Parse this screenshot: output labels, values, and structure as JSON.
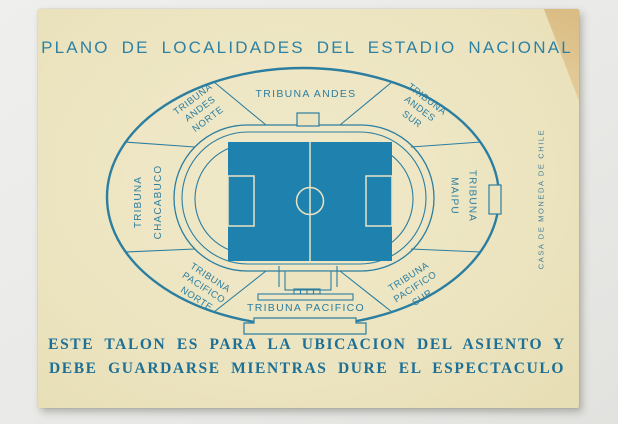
{
  "ticket": {
    "title": "PLANO DE LOCALIDADES DEL ESTADIO NACIONAL",
    "stadium": {
      "sections": {
        "andes": {
          "label": "TRIBUNA ANDES"
        },
        "andes_norte": {
          "lines": [
            "TRIBUNA",
            "ANDES",
            "NORTE"
          ]
        },
        "andes_sur": {
          "lines": [
            "TRIBUNA",
            "ANDES",
            "SUR"
          ]
        },
        "chacabuco": {
          "lines": [
            "TRIBUNA",
            "CHACABUCO"
          ]
        },
        "maipu": {
          "lines": [
            "TRIBUNA",
            "MAIPU"
          ]
        },
        "pacifico_norte": {
          "lines": [
            "TRIBUNA",
            "PACIFICO",
            "NORTE"
          ]
        },
        "pacifico": {
          "label": "TRIBUNA PACIFICO"
        },
        "pacifico_sur": {
          "lines": [
            "TRIBUNA",
            "PACIFICO",
            "SUR"
          ]
        }
      }
    },
    "footer": {
      "line1": "ESTE TALON ES PARA LA UBICACION DEL ASIENTO Y",
      "line2": "DEBE GUARDARSE MIENTRAS DURE EL ESPECTACULO"
    },
    "printer_mark": "CASA DE MONEDA DE CHILE",
    "colors": {
      "ink": "#2C7EA0",
      "footer_ink": "#1D6F95",
      "paper": "#ECE4BF",
      "field_blue": "#1F81AE",
      "field_line": "#EAE3C3",
      "corner_stain": "#DCBE85",
      "photo_background": "#E9E9E7"
    }
  }
}
